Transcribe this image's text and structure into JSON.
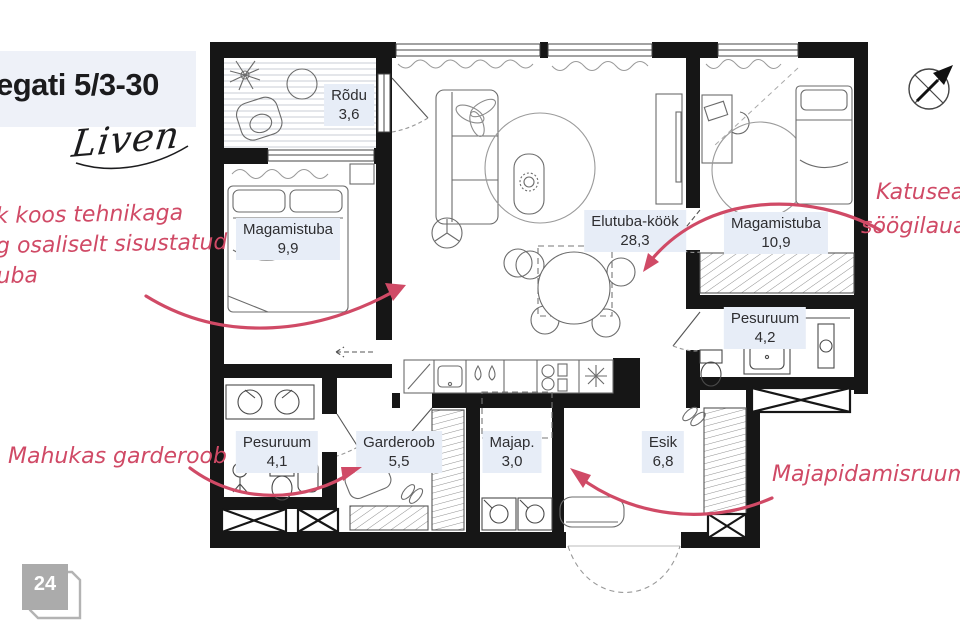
{
  "header": {
    "title": "egati 5/3-30",
    "brand": "Liven"
  },
  "annotations": {
    "left_lines": [
      "k koos tehnikaga",
      "g osaliselt sisustatud",
      "uba"
    ],
    "right_lines": [
      "Katuseake",
      "söögilaua k"
    ],
    "bottom_left": "Mahukas garderoob",
    "bottom_right": "Majapidamisruum"
  },
  "rooms": [
    {
      "id": "rodu",
      "name": "Rõdu",
      "area": "3,6"
    },
    {
      "id": "magamistuba-1",
      "name": "Magamistuba",
      "area": "9,9"
    },
    {
      "id": "elutuba-kook",
      "name": "Elutuba-köök",
      "area": "28,3"
    },
    {
      "id": "magamistuba-2",
      "name": "Magamistuba",
      "area": "10,9"
    },
    {
      "id": "pesuruum-2",
      "name": "Pesuruum",
      "area": "4,2"
    },
    {
      "id": "pesuruum-1",
      "name": "Pesuruum",
      "area": "4,1"
    },
    {
      "id": "garderoob",
      "name": "Garderoob",
      "area": "5,5"
    },
    {
      "id": "majapidamisruum",
      "name": "Majap.",
      "area": "3,0"
    },
    {
      "id": "esik",
      "name": "Esik",
      "area": "6,8"
    }
  ],
  "footer": {
    "page_number": "24"
  },
  "icons": {
    "compass": "north-arrow"
  },
  "colors": {
    "annotation_pink": "#d04a66",
    "wall": "#161616",
    "label_bg": "#e7edf7",
    "title_bg": "#eef1f8",
    "badge_gray": "#ababab"
  }
}
